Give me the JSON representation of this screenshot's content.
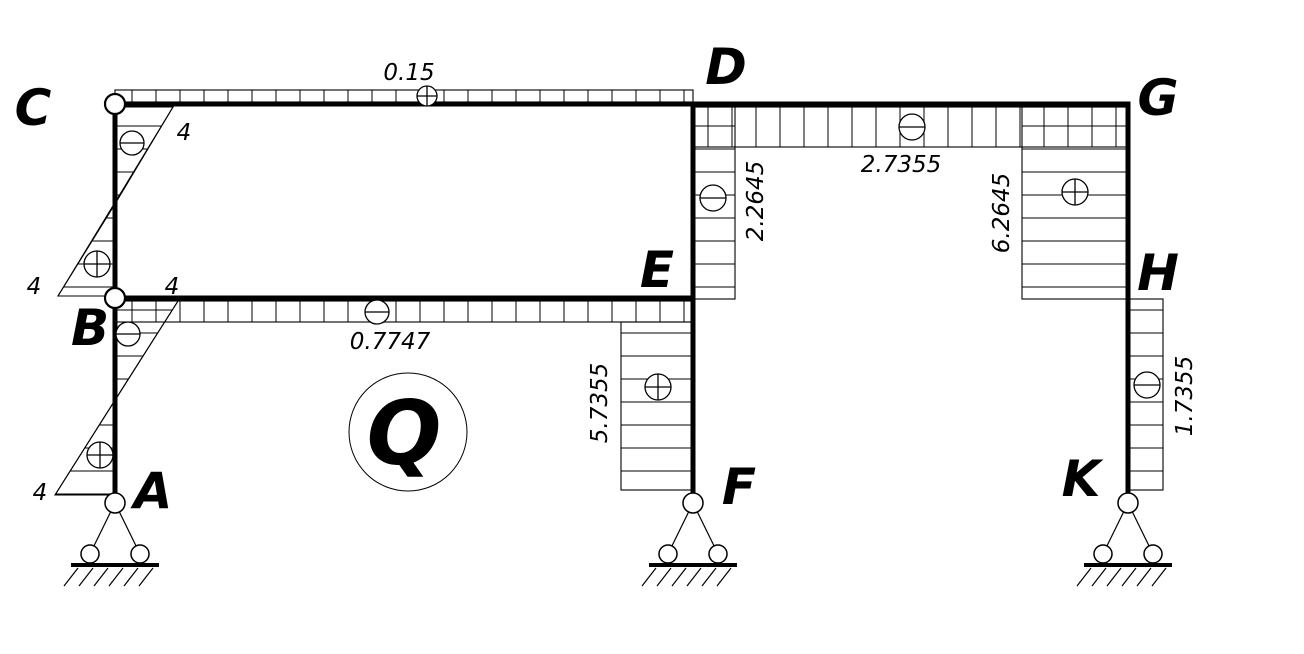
{
  "figure": {
    "type": "shear-force-diagram",
    "quantity_symbol": "Q"
  },
  "colors": {
    "ink": "#000000",
    "paper": "#ffffff"
  },
  "nodes": {
    "A": "A",
    "B": "B",
    "C": "C",
    "D": "D",
    "E": "E",
    "F": "F",
    "G": "G",
    "H": "H",
    "K": "K"
  },
  "diagram_values": {
    "beam_CD": {
      "value": "0.15",
      "sign": "plus"
    },
    "beam_DG": {
      "value": "2.7355",
      "sign": "minus"
    },
    "beam_BE": {
      "value": "0.7747",
      "sign": "minus"
    },
    "column_CB": {
      "value_top": "4",
      "sign_top": "minus",
      "value_bottom": "4",
      "sign_bottom": "plus"
    },
    "column_BA": {
      "value_top": "4",
      "sign_top": "minus",
      "value_bottom": "4",
      "sign_bottom": "plus"
    },
    "column_DE": {
      "value": "2.2645",
      "sign": "minus"
    },
    "column_EF": {
      "value": "5.7355",
      "sign": "plus"
    },
    "column_GH": {
      "value": "6.2645",
      "sign": "plus"
    },
    "column_HK": {
      "value": "1.7355",
      "sign": "minus"
    }
  },
  "supports": {
    "A": "pin",
    "F": "pin",
    "K": "pin"
  }
}
